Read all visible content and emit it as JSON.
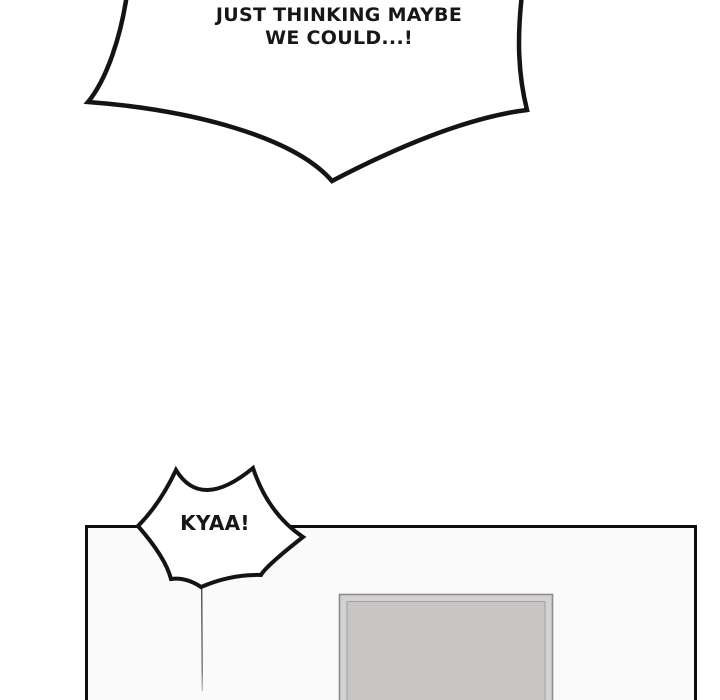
{
  "page": {
    "background_color": "#ffffff",
    "ink_color": "#141414"
  },
  "shout_bubble": {
    "line1": "JUST THINKING MAYBE",
    "line2": "WE COULD...!"
  },
  "burst_bubble": {
    "text": "KYAA!"
  },
  "panel": {
    "background_color": "#fafafa",
    "border_color": "#0e0e0e"
  },
  "picture_frame": {
    "outer_fill": "#d3d1d1",
    "outer_border": "#8d8b8b",
    "inner_fill": "#c8c5c5",
    "inner_border": "#a3a0a0"
  }
}
